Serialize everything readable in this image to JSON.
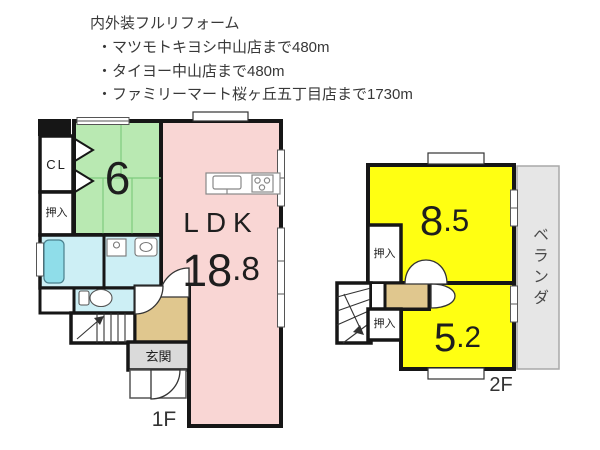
{
  "header": {
    "title": "内外装フルリフォーム",
    "bullets": [
      "・マツモトキヨシ中山店まで480m",
      "・タイヨー中山店まで480m",
      "・ファミリーマート桜ヶ丘五丁目店まで1730m"
    ]
  },
  "floor1": {
    "floor_label": "1F",
    "closet_label": "CL",
    "oshiire_label": "押入",
    "tatami_size": "6",
    "ldk_label": "LDK",
    "ldk_size": "18.8",
    "genkan_label": "玄関"
  },
  "floor2": {
    "floor_label": "2F",
    "room_a_size": "8.5",
    "room_b_size": "5.2",
    "oshiire_top_label": "押入",
    "oshiire_bottom_label": "押入",
    "veranda_label": "ベランダ"
  },
  "colors": {
    "wall": "#161616",
    "tatami_room": "#b9e9b2",
    "ldk_room": "#f9d6d4",
    "rooms_2f": "#ffff12",
    "wet_area": "#cdeff5",
    "bathtub": "#8fdde9",
    "hallway": "#e0c78e",
    "genkan": "#dadada",
    "veranda": "#e6e6e6"
  }
}
